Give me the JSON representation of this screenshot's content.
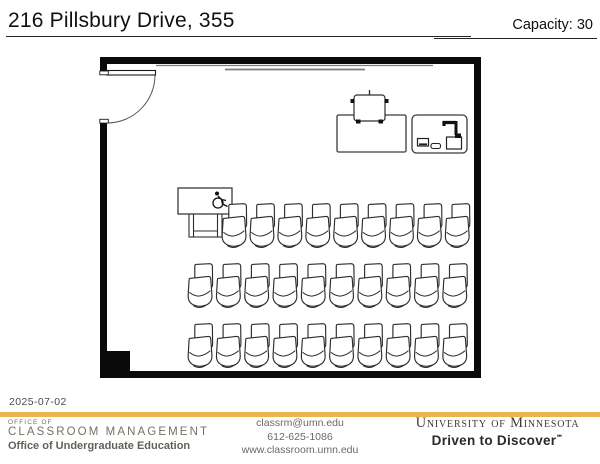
{
  "header": {
    "title": "216 Pillsbury Drive, 355",
    "capacity": "Capacity: 30"
  },
  "floorplan": {
    "wall_color": "#0a0a0a",
    "line_color": "#2d2d2d",
    "chair_rows": [
      {
        "count": 9,
        "x": 220,
        "y": 203,
        "spacing": 27.9
      },
      {
        "count": 10,
        "x": 186,
        "y": 263,
        "spacing": 28.3
      },
      {
        "count": 10,
        "x": 186,
        "y": 323,
        "spacing": 28.3
      }
    ],
    "features": [
      "door",
      "whiteboard",
      "projection-screen",
      "instructor-table",
      "instructor-chair",
      "lectern-station",
      "document-camera-icon",
      "monitor-icon",
      "keyboard-icon",
      "accessible-table",
      "wheelchair-icon",
      "pilaster-column",
      "student-chairs"
    ]
  },
  "footer": {
    "date": "2025-07-02",
    "accent_color": "#EBB54D",
    "office": {
      "line1": "OFFICE OF",
      "line2": "CLASSROOM MANAGEMENT",
      "line3": "Office of Undergraduate Education"
    },
    "contact": {
      "email": "classrm@umn.edu",
      "phone": "612-625-1086",
      "website": "www.classroom.umn.edu"
    },
    "brand": {
      "university": "University of Minnesota",
      "tagline": "Driven to Discover",
      "tagline_mark": "℠"
    }
  }
}
